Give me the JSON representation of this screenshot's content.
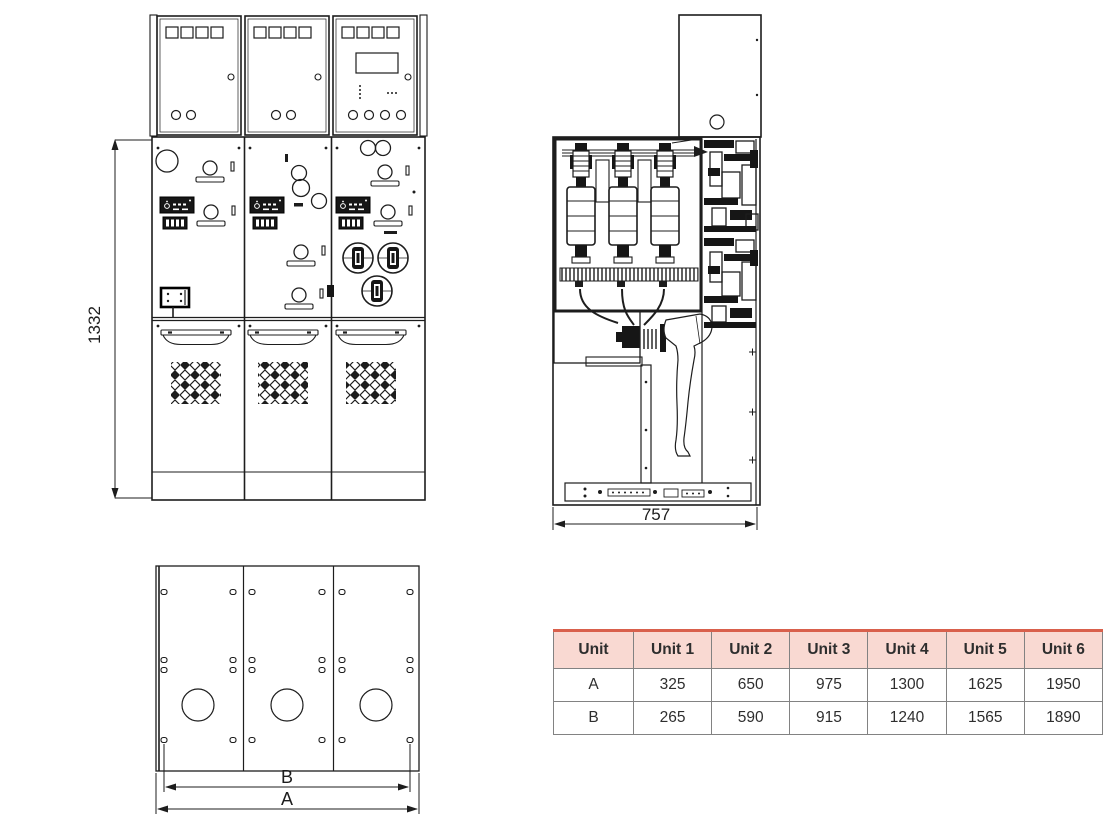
{
  "page": {
    "background": "#ffffff",
    "line_color": "#1d1d1d"
  },
  "drawing": {
    "front_view": {
      "description": "front elevation of 3-panel switchgear",
      "height_dim": "1332"
    },
    "side_view": {
      "description": "side section of switchgear",
      "width_dim": "757"
    },
    "bottom_view": {
      "description": "base plan with cable entries",
      "dim_inner": "B",
      "dim_outer": "A"
    }
  },
  "dims": {
    "front_height": "1332",
    "side_width": "757",
    "bottom_inner": "B",
    "bottom_outer": "A"
  },
  "table": {
    "accent_top_color": "#d9604c",
    "header_bg": "#f9d9d2",
    "border_color": "#828282",
    "columns": [
      "Unit",
      "Unit 1",
      "Unit 2",
      "Unit 3",
      "Unit 4",
      "Unit 5",
      "Unit 6"
    ],
    "rows": [
      {
        "label": "A",
        "values": [
          "325",
          "650",
          "975",
          "1300",
          "1625",
          "1950"
        ]
      },
      {
        "label": "B",
        "values": [
          "265",
          "590",
          "915",
          "1240",
          "1565",
          "1890"
        ]
      }
    ]
  },
  "chart_data": {
    "type": "table",
    "title": "Switchgear width per number of units",
    "columns": [
      "Unit",
      "Unit 1",
      "Unit 2",
      "Unit 3",
      "Unit 4",
      "Unit 5",
      "Unit 6"
    ],
    "series": [
      {
        "name": "A",
        "values": [
          325,
          650,
          975,
          1300,
          1625,
          1950
        ]
      },
      {
        "name": "B",
        "values": [
          265,
          590,
          915,
          1240,
          1565,
          1890
        ]
      }
    ]
  }
}
